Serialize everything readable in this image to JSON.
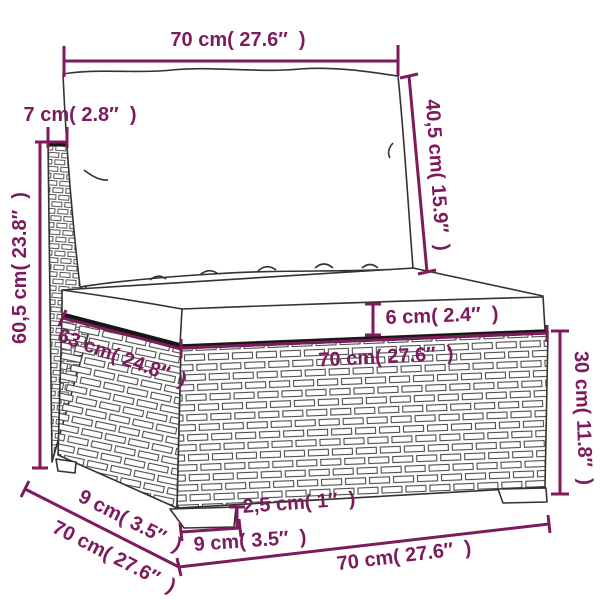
{
  "accent_color": "#7D1B5C",
  "labels": {
    "top_width": "70 cm( 27.6″  )",
    "back_cushion_height": "40,5 cm( 15.9″  )",
    "back_thickness": "7 cm( 2.8″  )",
    "total_height": "60,5 cm( 23.8″  )",
    "seat_cushion_thickness": "6 cm( 2.4″  )",
    "seat_width": "70 cm( 27.6″  )",
    "seat_depth": "63 cm( 24.8″  )",
    "base_height": "30 cm( 11.8″  )",
    "foot_depth": "9 cm( 3.5″  )",
    "total_depth": "70 cm( 27.6″  )",
    "foot_width": "9 cm( 3.5″  )",
    "foot_height": "2,5 cm( 1″  )",
    "bottom_width": "70 cm( 27.6″  )"
  }
}
